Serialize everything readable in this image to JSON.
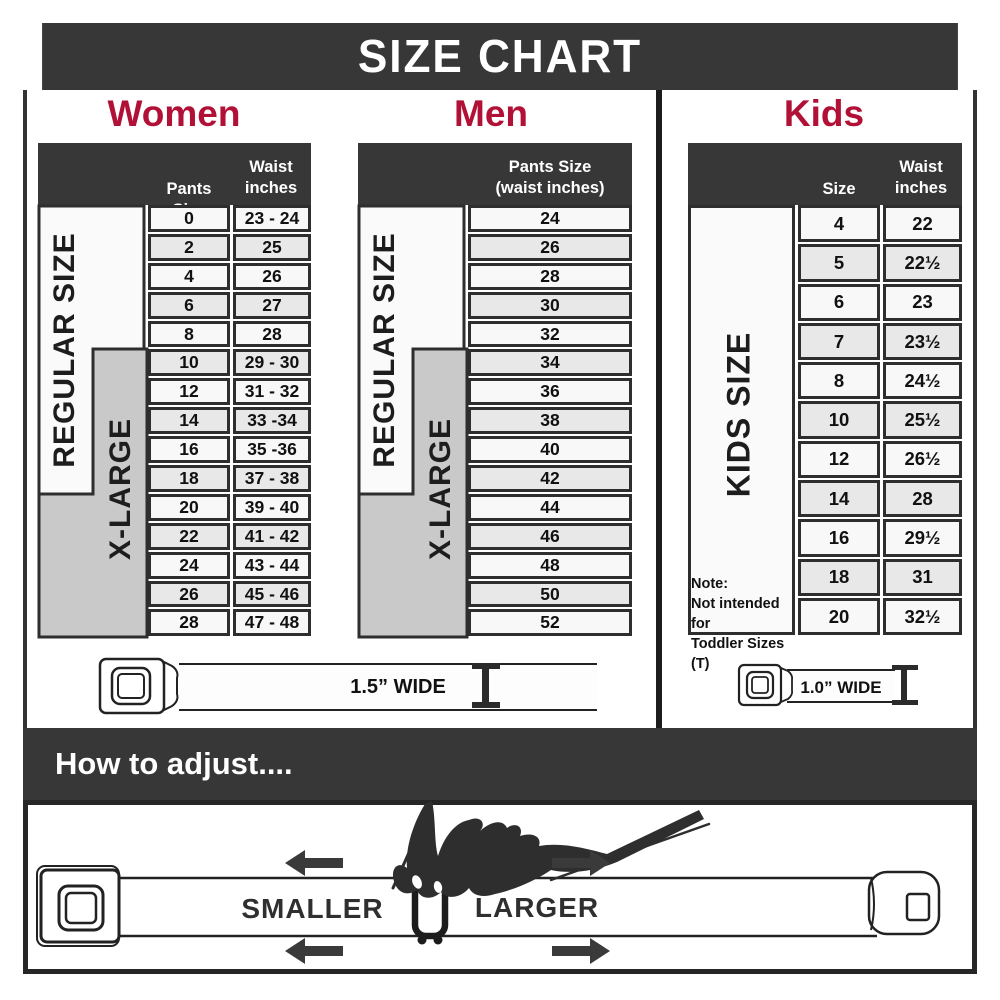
{
  "header": {
    "title": "SIZE CHART"
  },
  "sections": {
    "women": {
      "heading": "Women",
      "col_pants": "Pants Size",
      "col_waist_1": "Waist",
      "col_waist_2": "inches",
      "regular": "REGULAR SIZE",
      "xlarge": "X-LARGE"
    },
    "men": {
      "heading": "Men",
      "col_line1": "Pants Size",
      "col_line2": "(waist inches)",
      "regular": "REGULAR SIZE",
      "xlarge": "X-LARGE"
    },
    "kids": {
      "heading": "Kids",
      "col_size": "Size",
      "col_waist_1": "Waist",
      "col_waist_2": "inches",
      "label": "KIDS SIZE",
      "note_1": "Note:",
      "note_2": "Not intended for",
      "note_3": "Toddler Sizes (T)"
    }
  },
  "belts": {
    "adult": "1.5” WIDE",
    "kids": "1.0” WIDE"
  },
  "adjust": {
    "heading": "How to adjust....",
    "smaller": "SMALLER",
    "larger": "LARGER"
  },
  "colors": {
    "accent": "#B11136",
    "dark": "#373737",
    "row_light": "#f8f8f8",
    "row_alt": "#e8e8e8",
    "group_gray": "#c9c9c9"
  },
  "chart_data": [
    {
      "type": "table",
      "title": "Women",
      "columns": [
        "Pants Size",
        "Waist inches"
      ],
      "rows": [
        [
          "0",
          "23 - 24"
        ],
        [
          "2",
          "25"
        ],
        [
          "4",
          "26"
        ],
        [
          "6",
          "27"
        ],
        [
          "8",
          "28"
        ],
        [
          "10",
          "29 - 30"
        ],
        [
          "12",
          "31 - 32"
        ],
        [
          "14",
          "33 -34"
        ],
        [
          "16",
          "35 -36"
        ],
        [
          "18",
          "37 - 38"
        ],
        [
          "20",
          "39 - 40"
        ],
        [
          "22",
          "41 - 42"
        ],
        [
          "24",
          "43 - 44"
        ],
        [
          "26",
          "45 - 46"
        ],
        [
          "28",
          "47 - 48"
        ]
      ],
      "groups": [
        {
          "label": "REGULAR SIZE",
          "rows": "pants 0–18"
        },
        {
          "label": "X-LARGE",
          "rows": "pants 10–28"
        }
      ]
    },
    {
      "type": "table",
      "title": "Men",
      "columns": [
        "Pants Size (waist inches)"
      ],
      "rows": [
        [
          "24"
        ],
        [
          "26"
        ],
        [
          "28"
        ],
        [
          "30"
        ],
        [
          "32"
        ],
        [
          "34"
        ],
        [
          "36"
        ],
        [
          "38"
        ],
        [
          "40"
        ],
        [
          "42"
        ],
        [
          "44"
        ],
        [
          "46"
        ],
        [
          "48"
        ],
        [
          "50"
        ],
        [
          "52"
        ]
      ],
      "groups": [
        {
          "label": "REGULAR SIZE",
          "rows": "24–42"
        },
        {
          "label": "X-LARGE",
          "rows": "34–52"
        }
      ]
    },
    {
      "type": "table",
      "title": "Kids",
      "columns": [
        "Size",
        "Waist inches"
      ],
      "rows": [
        [
          "4",
          "22"
        ],
        [
          "5",
          "22½"
        ],
        [
          "6",
          "23"
        ],
        [
          "7",
          "23½"
        ],
        [
          "8",
          "24½"
        ],
        [
          "10",
          "25½"
        ],
        [
          "12",
          "26½"
        ],
        [
          "14",
          "28"
        ],
        [
          "16",
          "29½"
        ],
        [
          "18",
          "31"
        ],
        [
          "20",
          "32½"
        ]
      ],
      "groups": [
        {
          "label": "KIDS SIZE",
          "rows": "4–20"
        }
      ],
      "note": "Note: Not intended for Toddler Sizes (T)"
    }
  ]
}
